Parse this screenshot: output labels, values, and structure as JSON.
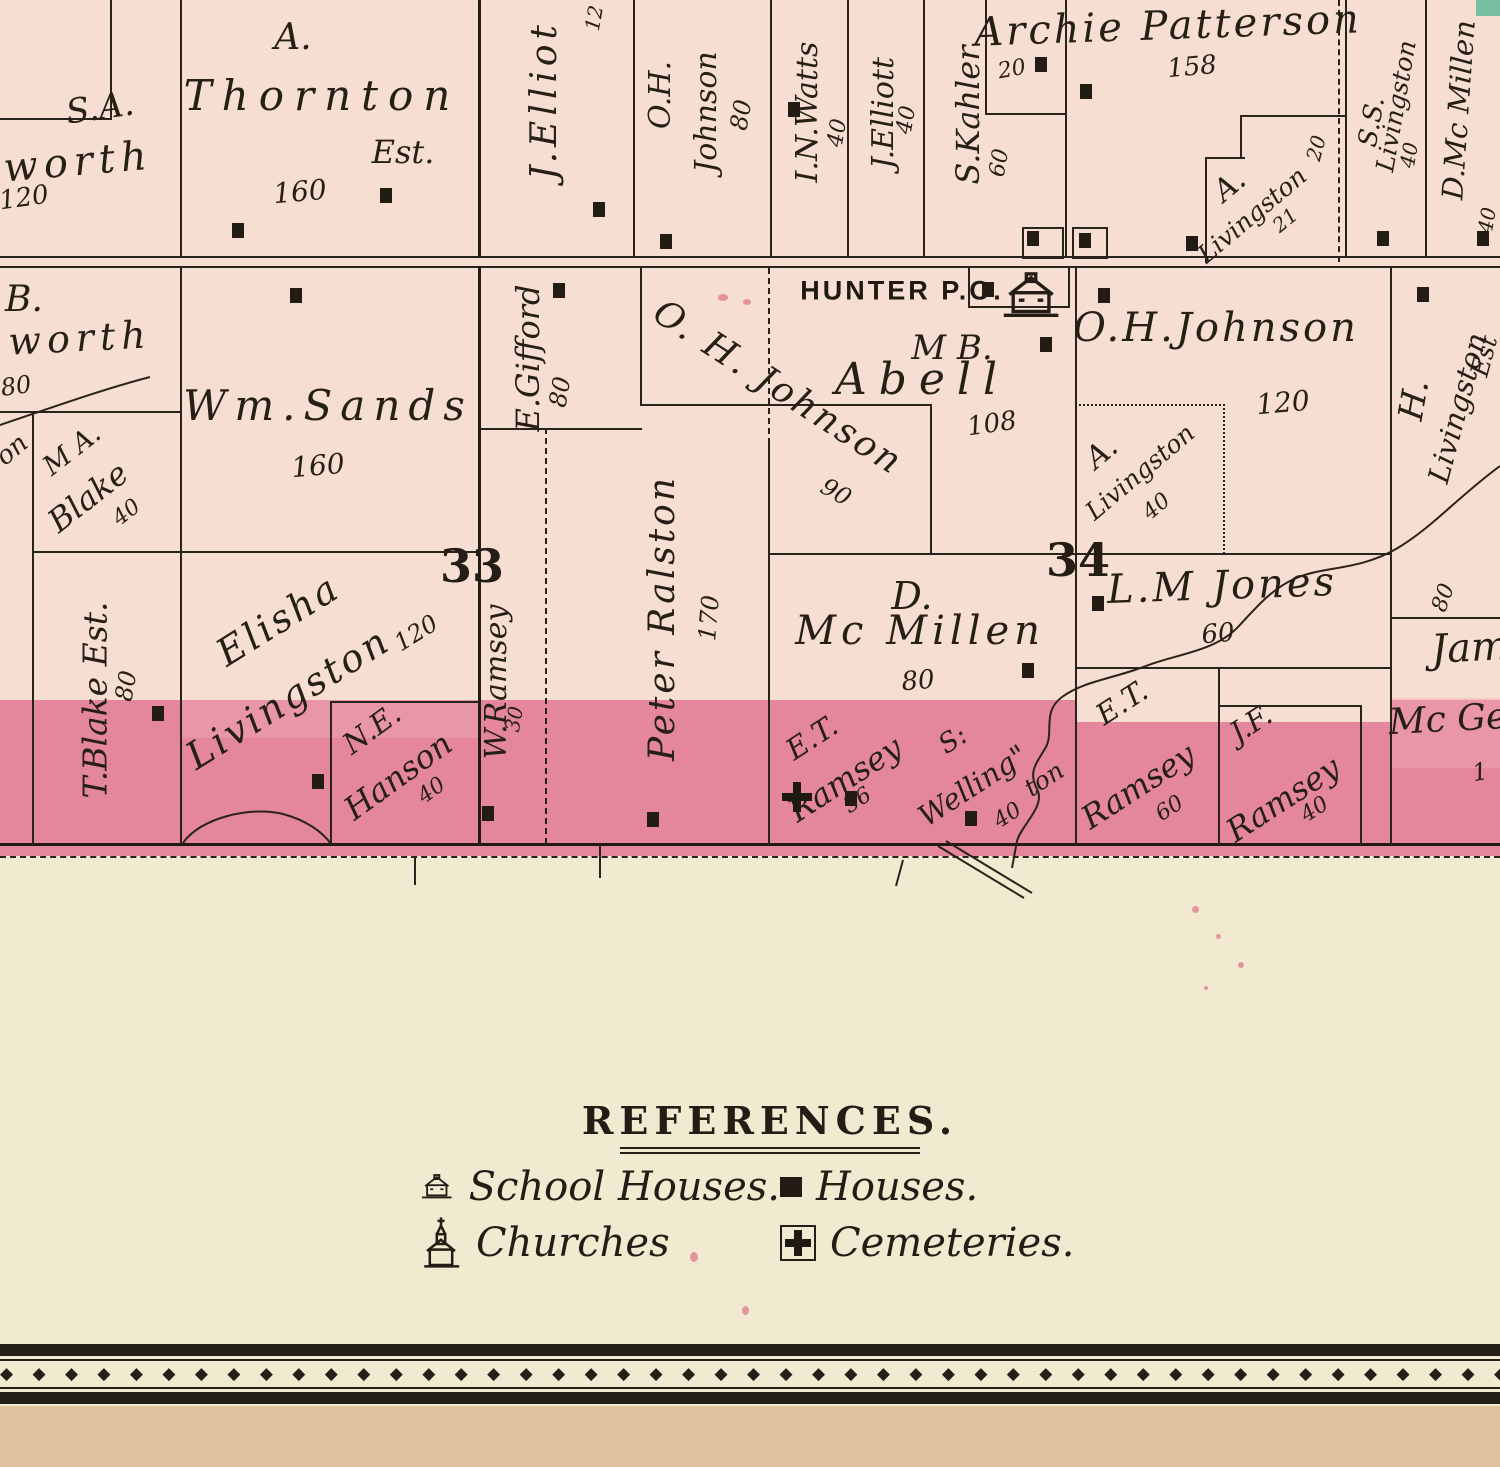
{
  "legend": {
    "title": "REFERENCES.",
    "items": [
      {
        "icon": "schoolhouse-icon",
        "label": "School Houses."
      },
      {
        "icon": "house-icon",
        "label": "Houses."
      },
      {
        "icon": "church-icon",
        "label": "Churches"
      },
      {
        "icon": "cemetery-icon",
        "label": "Cemeteries."
      }
    ]
  },
  "map": {
    "colors": {
      "parcel": "#f7ded2",
      "band": "#e4879c",
      "ink": "#2a231b",
      "sheet": "#f2ead0",
      "margin": "#dfc49f"
    },
    "section_numbers": [
      {
        "value": "33",
        "x": 472,
        "y": 566
      },
      {
        "value": "34",
        "x": 1078,
        "y": 560
      }
    ],
    "labels": [
      {
        "t": "S.A.",
        "x": 100,
        "y": 108,
        "r": -8,
        "s": 34
      },
      {
        "t": "worth",
        "x": 78,
        "y": 162,
        "r": -5,
        "s": 40,
        "sp": 6
      },
      {
        "t": "120",
        "x": 24,
        "y": 198,
        "r": -8,
        "s": 26
      },
      {
        "t": "A.",
        "x": 293,
        "y": 38,
        "r": 0,
        "s": 36
      },
      {
        "t": "Thornton",
        "x": 322,
        "y": 96,
        "r": 0,
        "s": 42,
        "sp": 10
      },
      {
        "t": "Est.",
        "x": 403,
        "y": 152,
        "r": 0,
        "s": 32
      },
      {
        "t": "160",
        "x": 300,
        "y": 192,
        "r": -5,
        "s": 28
      },
      {
        "t": "J.Elliot",
        "x": 545,
        "y": 100,
        "r": -90,
        "s": 36,
        "sp": 5
      },
      {
        "t": "12",
        "x": 594,
        "y": 18,
        "r": -80,
        "s": 20
      },
      {
        "t": "O.H.",
        "x": 661,
        "y": 95,
        "r": -90,
        "s": 30
      },
      {
        "t": "Johnson",
        "x": 707,
        "y": 112,
        "r": -90,
        "s": 30
      },
      {
        "t": "80",
        "x": 741,
        "y": 115,
        "r": -80,
        "s": 24
      },
      {
        "t": "I.N.Watts",
        "x": 808,
        "y": 112,
        "r": -90,
        "s": 30
      },
      {
        "t": "40",
        "x": 838,
        "y": 133,
        "r": -80,
        "s": 22
      },
      {
        "t": "J.Elliott",
        "x": 884,
        "y": 113,
        "r": -90,
        "s": 30
      },
      {
        "t": "40",
        "x": 907,
        "y": 120,
        "r": -80,
        "s": 22
      },
      {
        "t": "S.Kahler",
        "x": 968,
        "y": 115,
        "r": -90,
        "s": 32
      },
      {
        "t": "60",
        "x": 1000,
        "y": 163,
        "r": -80,
        "s": 22
      },
      {
        "t": "20",
        "x": 1012,
        "y": 70,
        "r": -10,
        "s": 22
      },
      {
        "t": "Archie Patterson",
        "x": 1168,
        "y": 26,
        "r": -2,
        "s": 40,
        "sp": 3
      },
      {
        "t": "158",
        "x": 1192,
        "y": 67,
        "r": -5,
        "s": 26
      },
      {
        "t": "A.",
        "x": 1230,
        "y": 186,
        "r": -40,
        "s": 30
      },
      {
        "t": "Livingston",
        "x": 1252,
        "y": 215,
        "r": -40,
        "s": 25
      },
      {
        "t": "21",
        "x": 1285,
        "y": 220,
        "r": -40,
        "s": 20
      },
      {
        "t": "20",
        "x": 1316,
        "y": 148,
        "r": -75,
        "s": 20
      },
      {
        "t": "S.S.",
        "x": 1372,
        "y": 122,
        "r": -80,
        "s": 26
      },
      {
        "t": "Livingston",
        "x": 1396,
        "y": 106,
        "r": -80,
        "s": 25
      },
      {
        "t": "40",
        "x": 1409,
        "y": 155,
        "r": -80,
        "s": 20
      },
      {
        "t": "D.Mc Millen",
        "x": 1459,
        "y": 110,
        "r": -86,
        "s": 29
      },
      {
        "t": "40",
        "x": 1487,
        "y": 220,
        "r": -80,
        "s": 20
      },
      {
        "t": "B.",
        "x": 24,
        "y": 300,
        "r": 0,
        "s": 36
      },
      {
        "t": "worth",
        "x": 80,
        "y": 338,
        "r": -3,
        "s": 38,
        "sp": 6
      },
      {
        "t": "80",
        "x": 16,
        "y": 386,
        "r": -8,
        "s": 24
      },
      {
        "t": "on",
        "x": 12,
        "y": 450,
        "r": -40,
        "s": 26
      },
      {
        "t": "M A.",
        "x": 72,
        "y": 450,
        "r": -38,
        "s": 27
      },
      {
        "t": "Blake",
        "x": 88,
        "y": 497,
        "r": -38,
        "s": 32
      },
      {
        "t": "40",
        "x": 127,
        "y": 513,
        "r": -38,
        "s": 22
      },
      {
        "t": "Wm.Sands",
        "x": 328,
        "y": 406,
        "r": 0,
        "s": 42,
        "sp": 8
      },
      {
        "t": "160",
        "x": 318,
        "y": 466,
        "r": -5,
        "s": 28
      },
      {
        "t": "E.Gifford",
        "x": 528,
        "y": 358,
        "r": -90,
        "s": 32
      },
      {
        "t": "80",
        "x": 560,
        "y": 392,
        "r": -80,
        "s": 24
      },
      {
        "t": "O. H. Johnson",
        "x": 778,
        "y": 388,
        "r": 33,
        "s": 36,
        "sp": 3
      },
      {
        "t": "90",
        "x": 836,
        "y": 492,
        "r": 30,
        "s": 24
      },
      {
        "t": "HUNTER P.O.",
        "x": 902,
        "y": 291,
        "r": 0,
        "s": 27,
        "sp": 3,
        "cls": "po",
        "n": "post-office-label"
      },
      {
        "t": "M B.",
        "x": 952,
        "y": 348,
        "r": 0,
        "s": 34
      },
      {
        "t": "Abell",
        "x": 922,
        "y": 380,
        "r": 0,
        "s": 44,
        "sp": 12
      },
      {
        "t": "108",
        "x": 992,
        "y": 424,
        "r": -8,
        "s": 26
      },
      {
        "t": "O.H.Johnson",
        "x": 1216,
        "y": 328,
        "r": 0,
        "s": 40,
        "sp": 3
      },
      {
        "t": "120",
        "x": 1283,
        "y": 403,
        "r": -5,
        "s": 28
      },
      {
        "t": "A.",
        "x": 1102,
        "y": 453,
        "r": -40,
        "s": 30
      },
      {
        "t": "Livingston",
        "x": 1140,
        "y": 472,
        "r": -40,
        "s": 25
      },
      {
        "t": "40",
        "x": 1157,
        "y": 507,
        "r": -40,
        "s": 22
      },
      {
        "t": "H.",
        "x": 1414,
        "y": 400,
        "r": -80,
        "s": 34
      },
      {
        "t": "Livingston",
        "x": 1458,
        "y": 408,
        "r": -75,
        "s": 29
      },
      {
        "t": "Est",
        "x": 1484,
        "y": 356,
        "r": -75,
        "s": 25
      },
      {
        "t": "80",
        "x": 1444,
        "y": 598,
        "r": -70,
        "s": 22
      },
      {
        "t": "T.Blake Est.",
        "x": 95,
        "y": 700,
        "r": -90,
        "s": 33
      },
      {
        "t": "80",
        "x": 126,
        "y": 686,
        "r": -80,
        "s": 24
      },
      {
        "t": "W.Ramsey",
        "x": 497,
        "y": 682,
        "r": -90,
        "s": 30
      },
      {
        "t": "30",
        "x": 514,
        "y": 719,
        "r": -80,
        "s": 20
      },
      {
        "t": "Peter Ralston",
        "x": 663,
        "y": 618,
        "r": -90,
        "s": 36,
        "sp": 3
      },
      {
        "t": "170",
        "x": 709,
        "y": 618,
        "r": -85,
        "s": 24
      },
      {
        "t": "Elisha",
        "x": 278,
        "y": 620,
        "r": -32,
        "s": 38,
        "sp": 3
      },
      {
        "t": "Livingston",
        "x": 288,
        "y": 698,
        "r": -32,
        "s": 38,
        "sp": 3
      },
      {
        "t": "120",
        "x": 416,
        "y": 633,
        "r": -32,
        "s": 24
      },
      {
        "t": "N.E.",
        "x": 372,
        "y": 729,
        "r": -36,
        "s": 29
      },
      {
        "t": "Hanson",
        "x": 398,
        "y": 776,
        "r": -36,
        "s": 32
      },
      {
        "t": "40",
        "x": 432,
        "y": 791,
        "r": -36,
        "s": 22
      },
      {
        "t": "D.",
        "x": 912,
        "y": 596,
        "r": 0,
        "s": 38
      },
      {
        "t": "Mc Millen",
        "x": 920,
        "y": 631,
        "r": 0,
        "s": 40,
        "sp": 5
      },
      {
        "t": "80",
        "x": 918,
        "y": 681,
        "r": -5,
        "s": 26
      },
      {
        "t": "E.T.",
        "x": 812,
        "y": 738,
        "r": -33,
        "s": 29
      },
      {
        "t": "Ramsey",
        "x": 845,
        "y": 779,
        "r": -33,
        "s": 32
      },
      {
        "t": "36",
        "x": 858,
        "y": 801,
        "r": -33,
        "s": 22
      },
      {
        "t": "S:",
        "x": 953,
        "y": 740,
        "r": -33,
        "s": 27
      },
      {
        "t": "Welling\"",
        "x": 973,
        "y": 786,
        "r": -33,
        "s": 29
      },
      {
        "t": "ton",
        "x": 1044,
        "y": 779,
        "r": -33,
        "s": 25
      },
      {
        "t": "40",
        "x": 1008,
        "y": 816,
        "r": -33,
        "s": 22
      },
      {
        "t": "E.T.",
        "x": 1122,
        "y": 703,
        "r": -33,
        "s": 29
      },
      {
        "t": "Ramsey",
        "x": 1138,
        "y": 786,
        "r": -33,
        "s": 32
      },
      {
        "t": "60",
        "x": 1170,
        "y": 809,
        "r": -33,
        "s": 22
      },
      {
        "t": "J.F.",
        "x": 1251,
        "y": 724,
        "r": -33,
        "s": 29
      },
      {
        "t": "Ramsey",
        "x": 1283,
        "y": 799,
        "r": -33,
        "s": 32
      },
      {
        "t": "40",
        "x": 1315,
        "y": 810,
        "r": -33,
        "s": 22
      },
      {
        "t": "L.M Jones",
        "x": 1222,
        "y": 586,
        "r": -2,
        "s": 40,
        "sp": 3
      },
      {
        "t": "60",
        "x": 1218,
        "y": 634,
        "r": -5,
        "s": 26
      },
      {
        "t": "Jam",
        "x": 1470,
        "y": 648,
        "r": -3,
        "s": 40
      },
      {
        "t": "Mc Ge",
        "x": 1448,
        "y": 720,
        "r": -3,
        "s": 36
      },
      {
        "t": "1",
        "x": 1480,
        "y": 772,
        "r": -10,
        "s": 24
      }
    ],
    "houses": [
      [
        232,
        223
      ],
      [
        380,
        188
      ],
      [
        788,
        102
      ],
      [
        593,
        202
      ],
      [
        660,
        234
      ],
      [
        1080,
        84
      ],
      [
        1035,
        57
      ],
      [
        1027,
        231
      ],
      [
        1079,
        233
      ],
      [
        1186,
        236
      ],
      [
        1377,
        231
      ],
      [
        1477,
        231
      ],
      [
        290,
        288
      ],
      [
        553,
        283
      ],
      [
        982,
        282
      ],
      [
        1040,
        337
      ],
      [
        1098,
        288
      ],
      [
        1417,
        287
      ],
      [
        152,
        706
      ],
      [
        312,
        774
      ],
      [
        482,
        806
      ],
      [
        647,
        812
      ],
      [
        845,
        791
      ],
      [
        965,
        811
      ],
      [
        1022,
        663
      ],
      [
        1092,
        596
      ]
    ],
    "lots": [
      [
        1022,
        227,
        38,
        28
      ],
      [
        1072,
        227,
        32,
        28
      ]
    ],
    "cemetery_marks": [
      [
        797,
        797
      ]
    ],
    "schoolhouse_marks": [
      [
        1032,
        296
      ]
    ]
  },
  "geometry": {
    "h": [
      [
        0,
        256,
        1500,
        "s"
      ],
      [
        0,
        266,
        1500,
        "s"
      ],
      [
        0,
        118,
        112,
        "s"
      ],
      [
        985,
        113,
        80,
        "s"
      ],
      [
        1240,
        115,
        106,
        "s"
      ],
      [
        1205,
        157,
        40,
        "s"
      ],
      [
        968,
        306,
        102,
        "s"
      ],
      [
        0,
        411,
        180,
        "s"
      ],
      [
        32,
        551,
        448,
        "s"
      ],
      [
        330,
        701,
        150,
        "s"
      ],
      [
        478,
        428,
        164,
        "s"
      ],
      [
        640,
        404,
        292,
        "s"
      ],
      [
        768,
        553,
        309,
        "s"
      ],
      [
        1075,
        553,
        317,
        "s"
      ],
      [
        1075,
        667,
        317,
        "s"
      ],
      [
        1218,
        705,
        144,
        "s"
      ],
      [
        1390,
        617,
        110,
        "s"
      ],
      [
        1075,
        404,
        150,
        "o"
      ],
      [
        0,
        843,
        1500,
        "b"
      ],
      [
        0,
        856,
        1500,
        "d"
      ]
    ],
    "v": [
      [
        110,
        0,
        120,
        "s"
      ],
      [
        180,
        0,
        258,
        "s"
      ],
      [
        478,
        0,
        258,
        "b"
      ],
      [
        633,
        0,
        258,
        "s"
      ],
      [
        770,
        0,
        258,
        "s"
      ],
      [
        847,
        0,
        258,
        "s"
      ],
      [
        923,
        0,
        258,
        "s"
      ],
      [
        985,
        0,
        115,
        "s"
      ],
      [
        1065,
        0,
        258,
        "s"
      ],
      [
        1345,
        0,
        258,
        "s"
      ],
      [
        1338,
        0,
        262,
        "d"
      ],
      [
        1425,
        0,
        258,
        "s"
      ],
      [
        1205,
        157,
        106,
        "s"
      ],
      [
        1240,
        115,
        44,
        "s"
      ],
      [
        32,
        411,
        434,
        "s"
      ],
      [
        180,
        266,
        578,
        "s"
      ],
      [
        478,
        266,
        578,
        "b"
      ],
      [
        330,
        701,
        143,
        "s"
      ],
      [
        640,
        266,
        140,
        "s"
      ],
      [
        545,
        428,
        416,
        "d"
      ],
      [
        768,
        268,
        176,
        "d"
      ],
      [
        768,
        444,
        400,
        "s"
      ],
      [
        930,
        404,
        150,
        "s"
      ],
      [
        968,
        266,
        42,
        "s"
      ],
      [
        1068,
        266,
        42,
        "s"
      ],
      [
        1075,
        266,
        578,
        "s"
      ],
      [
        1223,
        404,
        150,
        "o"
      ],
      [
        1390,
        266,
        578,
        "s"
      ],
      [
        1218,
        667,
        177,
        "s"
      ],
      [
        1360,
        705,
        139,
        "s"
      ]
    ]
  },
  "ornament": {
    "glyph": "◆"
  }
}
